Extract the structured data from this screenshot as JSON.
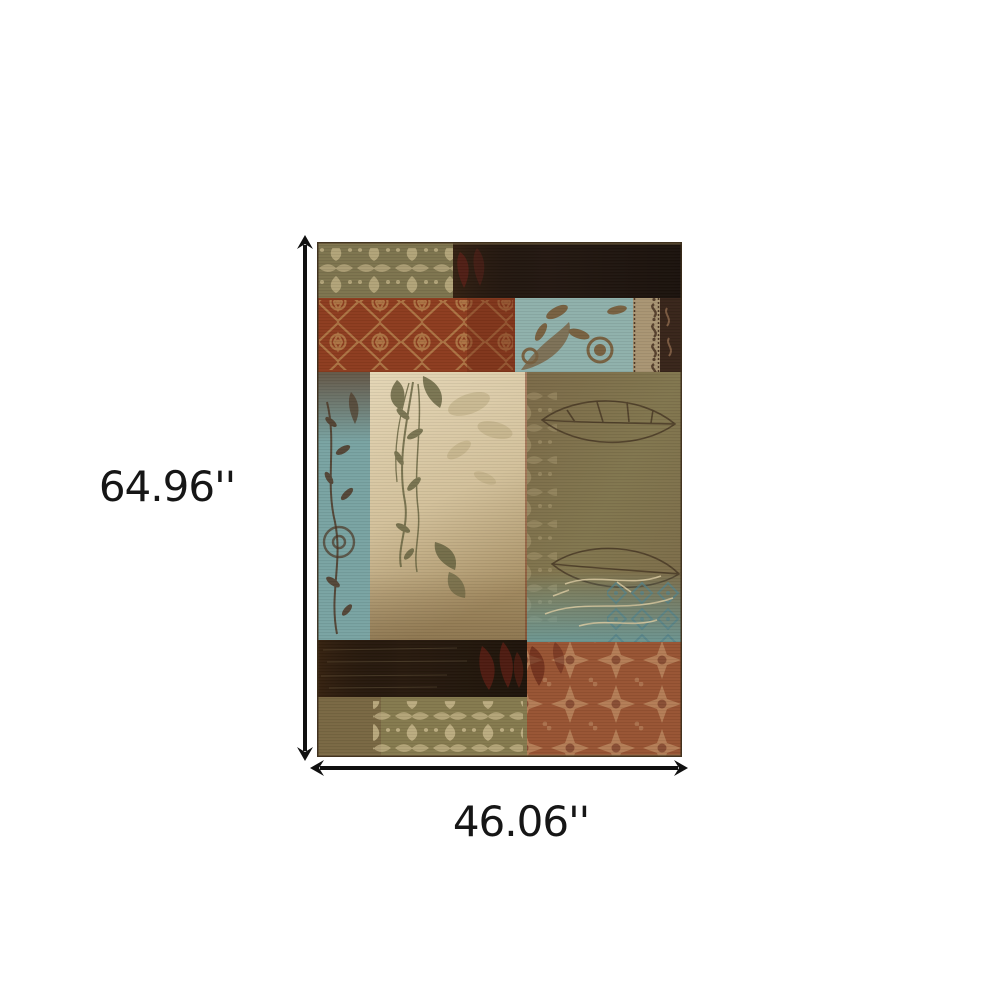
{
  "page": {
    "background": "#ffffff",
    "description": "Product dimension image of a patchwork floral area rug with height and width measurement arrows"
  },
  "dimensions": {
    "height_label": "64.96''",
    "width_label": "46.06''",
    "arrow_color": "#101010",
    "label_color": "#161616"
  },
  "rug": {
    "name": "patchwork area rug",
    "description": "Rectangular rug composed of patchwork blocks: olive damask, dark brown, rust-red damask, blue floral, cream botanical branches, olive leaf outlines and rust medallion panels",
    "palette": {
      "outline": "#3c2d1c",
      "edge_light": "#8f7d56",
      "olive_top": "#7d744e",
      "dark_brown": "#241811",
      "red_base": "#8d3c1f",
      "red_shade": "#6e2a16",
      "blue_floral": "#8fb0ab",
      "border_tan": "#a99573",
      "border_dark": "#38251a",
      "blue_strip": "#79a3a2",
      "cream_light": "#e4d6b6",
      "cream_mid": "#d3c19b",
      "cream_dark": "#a68e63",
      "olive_brown": "#7b6a48",
      "olive_mid": "#81764e",
      "bar_dark": "#281a0e",
      "olive_bottom": "#857a4e",
      "brown_bottom": "#6f5a3b",
      "rust": "#985433",
      "damask_beige": "#c9b88c",
      "lattice_tan": "#b07a48",
      "floral_brown": "#74542f",
      "branch_dark": "#4e3826",
      "leaf_olive": "#63603d",
      "leaf_outline": "#463623",
      "vein_light": "#d9c9a0",
      "blue_motif": "#52828a",
      "red_leaf": "#5e1f13",
      "rust_motif": "#c09067",
      "maroon": "#5c2017",
      "light_leaf": "#b9a87d"
    }
  }
}
